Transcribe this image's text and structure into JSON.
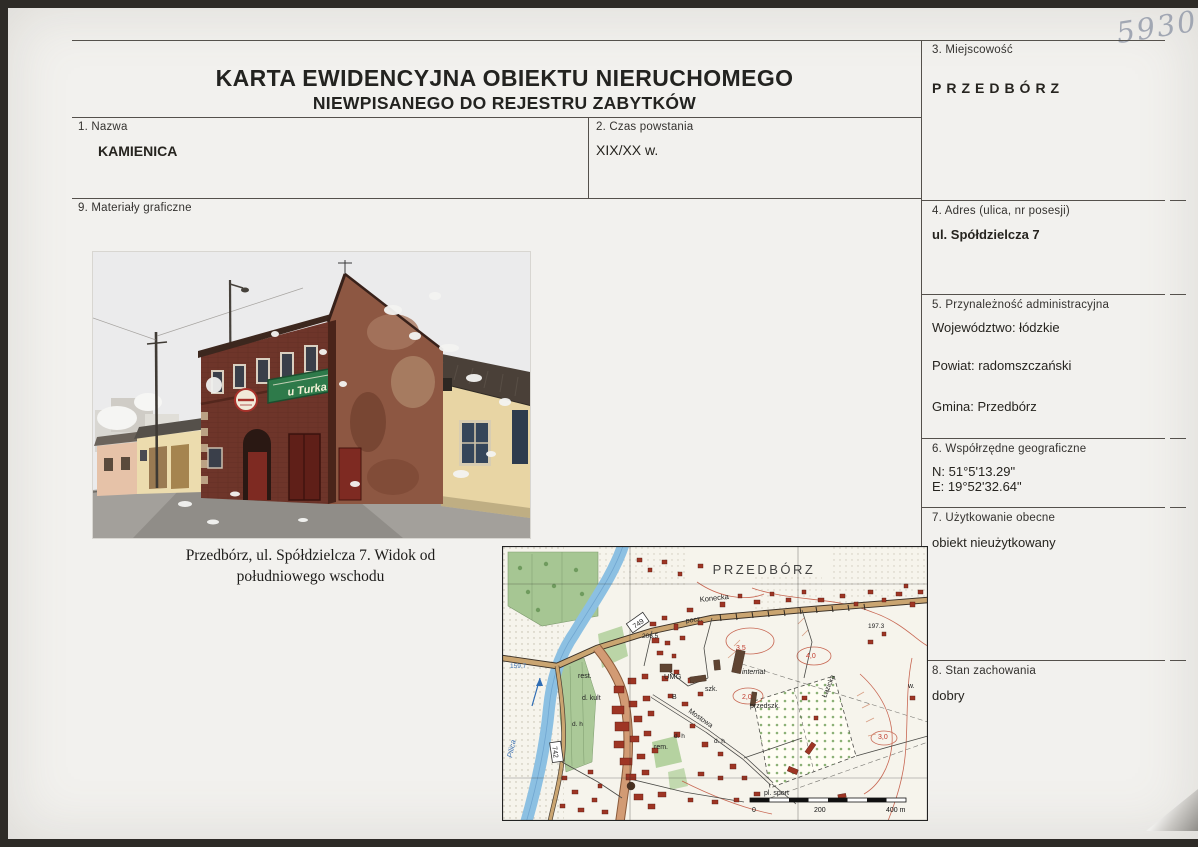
{
  "page": {
    "handwritten_number": "5930",
    "title_line1": "KARTA EWIDENCYJNA OBIEKTU NIERUCHOMEGO",
    "title_line2": "NIEWPISANEGO DO REJESTRU ZABYTKÓW"
  },
  "fields": {
    "f1": {
      "label": "1. Nazwa",
      "value": "KAMIENICA"
    },
    "f2": {
      "label": "2. Czas powstania",
      "value": "XIX/XX w."
    },
    "f3": {
      "label": "3. Miejscowość",
      "value": "PRZEDBÓRZ"
    },
    "f4": {
      "label": "4. Adres (ulica, nr posesji)",
      "value": "ul. Spółdzielcza 7"
    },
    "f5": {
      "label": "5. Przynależność administracyjna",
      "values": [
        "Województwo: łódzkie",
        "Powiat: radomszczański",
        "Gmina: Przedbórz"
      ]
    },
    "f6": {
      "label": "6. Współrzędne geograficzne",
      "values": [
        "N: 51°5'13.29\"",
        "E: 19°52'32.64\""
      ]
    },
    "f7": {
      "label": "7. Użytkowanie obecne",
      "value": "obiekt nieużytkowany"
    },
    "f8": {
      "label": "8. Stan zachowania",
      "value": "dobry"
    },
    "f9": {
      "label": "9. Materiały graficzne"
    }
  },
  "photo": {
    "caption_line1": "Przedbórz, ul. Spółdzielcza 7. Widok od",
    "caption_line2": "południowego wschodu",
    "sign_text": "u Turka"
  },
  "map": {
    "title": "PRZEDBÓRZ",
    "street_konecka": "Konecka",
    "road_749": "749",
    "road_742": "742",
    "post": "pocz.",
    "elev_206": "206.5",
    "umg": "UMG",
    "school": "szk.",
    "internat": "internat",
    "preschool": "przedszk.",
    "rest": "rest.",
    "culture": "d. kult",
    "dh1": "d. h",
    "dh2": "d. h",
    "dh3": "d. h",
    "rem": "rem.",
    "b": "B",
    "street_mostowa": "Mostowa",
    "street_lazicka": "Łazicka",
    "sport": "pl. sport",
    "river": "Pilica",
    "elev_159": "159.7",
    "elev_197": "197.3",
    "c35": "3,5",
    "c40": "4,0",
    "c20": "2,0",
    "c30": "3,0",
    "w": "w.",
    "scale0": "0",
    "scale200": "200",
    "scale400": "400 m"
  },
  "colors": {
    "accent_brick": "#6e352a",
    "accent_green_sign": "#2e7a4a",
    "map_building_red": "#9e3524",
    "map_river_blue": "#8cc0e2",
    "map_road_tan": "#caa571"
  }
}
